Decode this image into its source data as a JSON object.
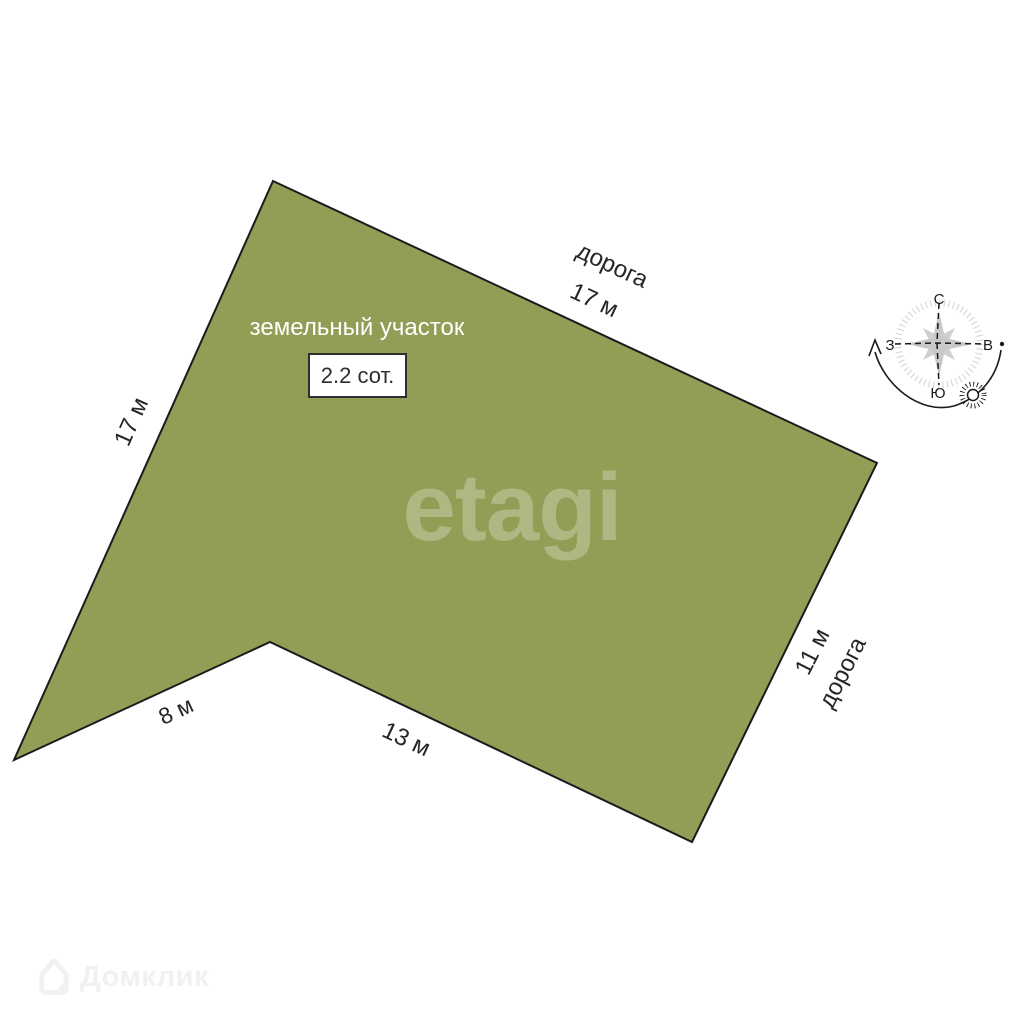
{
  "plot": {
    "label": "земельный участок",
    "area": "2.2 сот.",
    "fill_color": "#929d56",
    "outline_color": "#1b1b1b"
  },
  "edges": {
    "top_road_label": "дорога",
    "top_length": "17 м",
    "left_length": "17 м",
    "bottom_left_length": "8 м",
    "bottom_length": "13 м",
    "right_length": "11 м",
    "right_road_label": "дорога"
  },
  "compass": {
    "north_label": "С",
    "south_label": "Ю",
    "west_label": "З",
    "east_label": "В"
  },
  "watermarks": {
    "center_logo": "etagi",
    "corner_logo": "Домклик"
  }
}
